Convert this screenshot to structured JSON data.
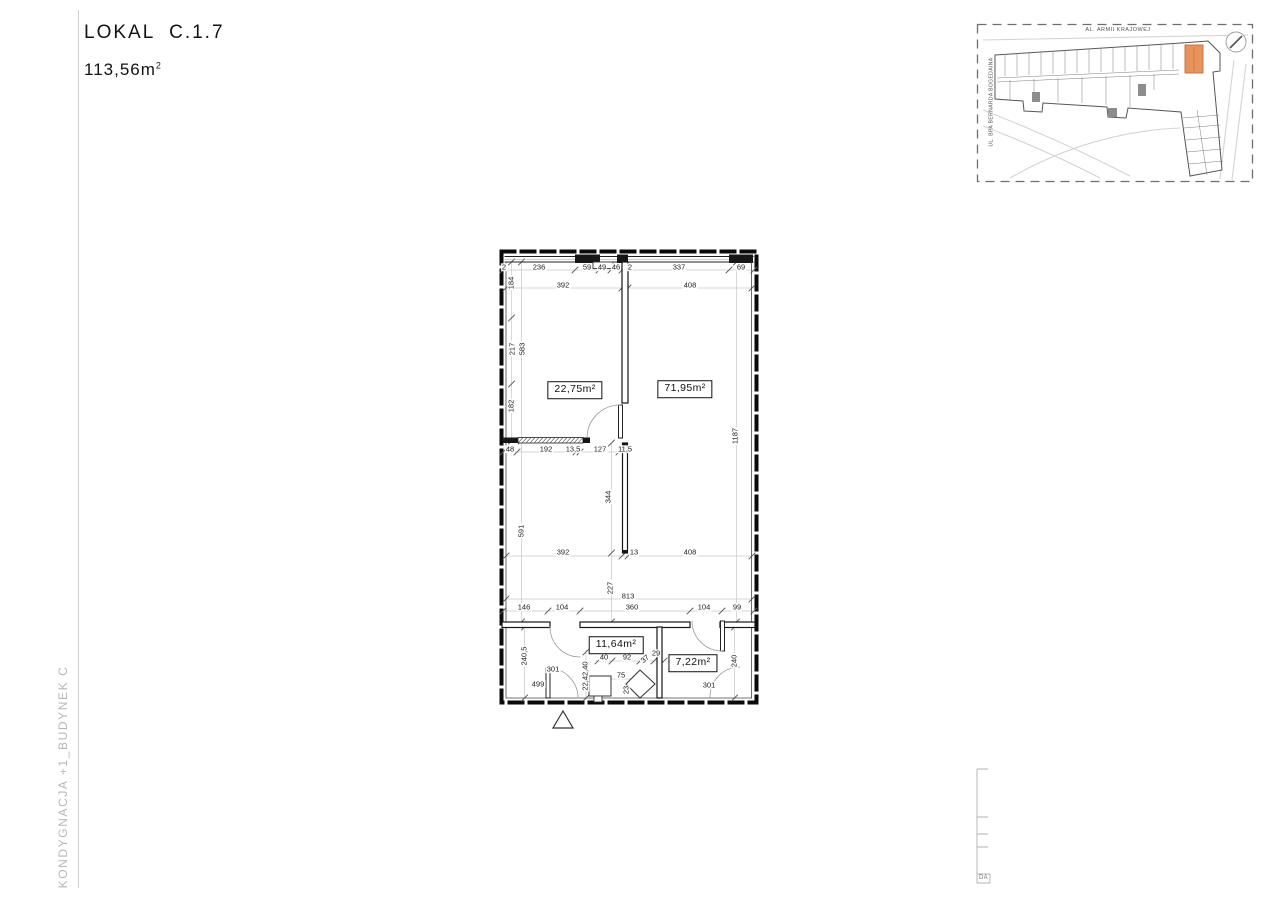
{
  "header": {
    "title": "LOKAL  C.1.7",
    "area_value": "113,56m",
    "area_sup": "2"
  },
  "side_label": "KONDYGNACJA +1_BUDYNEK C",
  "site_map": {
    "street_top": "AL. ARMII KRAJOWEJ",
    "street_left": "UL. BPA BERNARDA BOGEDAINA",
    "highlight_color": "#e8935c"
  },
  "title_block": {
    "label": "DA"
  },
  "floor_plan": {
    "rooms": [
      {
        "label": "22,75m²",
        "x": 575,
        "y": 390
      },
      {
        "label": "71,95m²",
        "x": 685,
        "y": 389
      },
      {
        "label": "11,64m²",
        "x": 616,
        "y": 645
      },
      {
        "label": "7,22m²",
        "x": 693,
        "y": 663
      }
    ],
    "dims": [
      {
        "t": "2",
        "x": 504,
        "y": 267
      },
      {
        "t": "236",
        "x": 539,
        "y": 267
      },
      {
        "t": "59",
        "x": 587,
        "y": 267
      },
      {
        "t": "49",
        "x": 602,
        "y": 267
      },
      {
        "t": "46",
        "x": 616,
        "y": 267
      },
      {
        "t": "2",
        "x": 630,
        "y": 267
      },
      {
        "t": "337",
        "x": 679,
        "y": 267
      },
      {
        "t": "69",
        "x": 741,
        "y": 267
      },
      {
        "t": "392",
        "x": 563,
        "y": 285
      },
      {
        "t": "408",
        "x": 690,
        "y": 285
      },
      {
        "t": "184",
        "x": 511,
        "y": 283,
        "r": -90
      },
      {
        "t": "217",
        "x": 512,
        "y": 349,
        "r": -90
      },
      {
        "t": "583",
        "x": 522,
        "y": 349,
        "r": -90
      },
      {
        "t": "182",
        "x": 511,
        "y": 406,
        "r": -90
      },
      {
        "t": "591",
        "x": 521,
        "y": 531,
        "r": -90
      },
      {
        "t": "240,5",
        "x": 524,
        "y": 656,
        "r": -90
      },
      {
        "t": "48",
        "x": 510,
        "y": 449
      },
      {
        "t": "192",
        "x": 546,
        "y": 449
      },
      {
        "t": "13,5",
        "x": 573,
        "y": 449
      },
      {
        "t": "127",
        "x": 600,
        "y": 449
      },
      {
        "t": "11,5",
        "x": 625,
        "y": 449
      },
      {
        "t": "344",
        "x": 608,
        "y": 497,
        "r": -90
      },
      {
        "t": "227",
        "x": 610,
        "y": 588,
        "r": -90
      },
      {
        "t": "1187",
        "x": 735,
        "y": 436,
        "r": -90
      },
      {
        "t": "392",
        "x": 563,
        "y": 552
      },
      {
        "t": "13",
        "x": 634,
        "y": 552
      },
      {
        "t": "408",
        "x": 690,
        "y": 552
      },
      {
        "t": "813",
        "x": 628,
        "y": 596
      },
      {
        "t": "146",
        "x": 524,
        "y": 607
      },
      {
        "t": "104",
        "x": 562,
        "y": 607
      },
      {
        "t": "360",
        "x": 632,
        "y": 607
      },
      {
        "t": "104",
        "x": 704,
        "y": 607
      },
      {
        "t": "99",
        "x": 737,
        "y": 607
      },
      {
        "t": "301",
        "x": 553,
        "y": 669
      },
      {
        "t": "499",
        "x": 538,
        "y": 684
      },
      {
        "t": "301",
        "x": 709,
        "y": 685
      },
      {
        "t": "240",
        "x": 734,
        "y": 661,
        "r": -90
      },
      {
        "t": "22,42,40",
        "x": 585,
        "y": 676,
        "r": -90
      },
      {
        "t": "40",
        "x": 604,
        "y": 657
      },
      {
        "t": "92",
        "x": 627,
        "y": 657
      },
      {
        "t": "29",
        "x": 656,
        "y": 653
      },
      {
        "t": "37",
        "x": 645,
        "y": 659,
        "r": -40
      },
      {
        "t": "75",
        "x": 621,
        "y": 675
      },
      {
        "t": "23",
        "x": 626,
        "y": 690,
        "r": -90
      }
    ]
  }
}
